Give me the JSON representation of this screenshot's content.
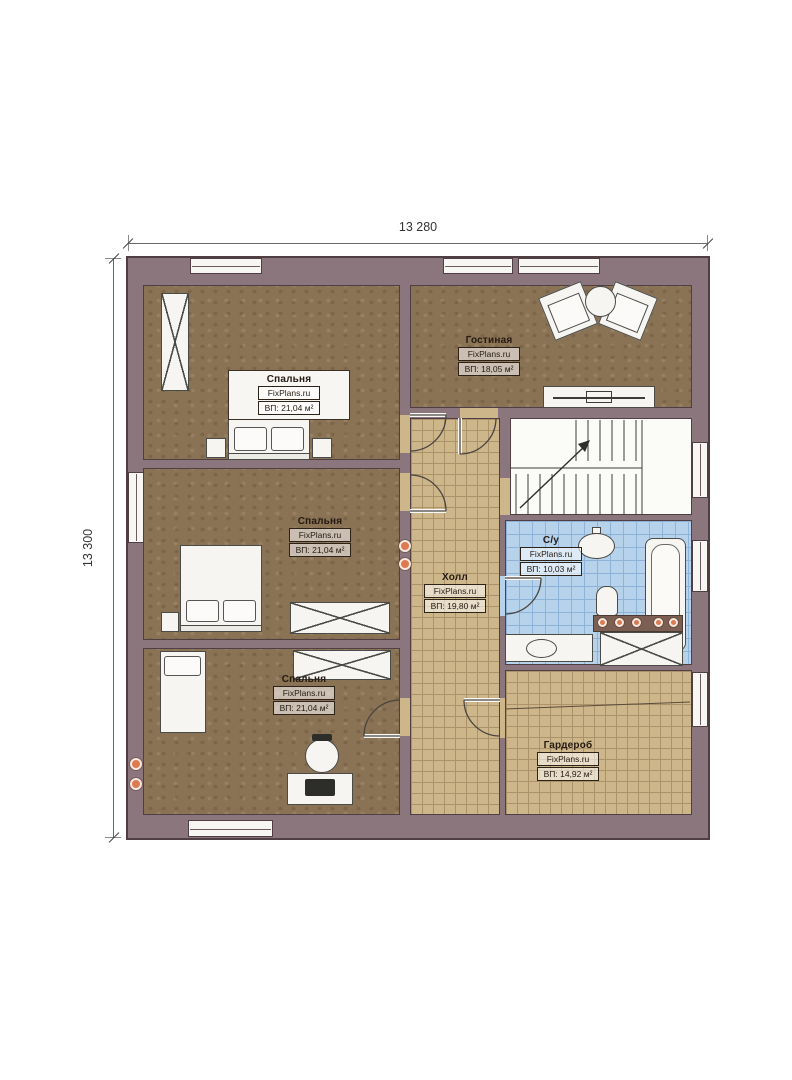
{
  "watermark": "FixPlans.ru",
  "dimensions": {
    "width_label": "13 280",
    "height_label": "13 300"
  },
  "rooms": [
    {
      "id": "bedroom-1",
      "name": "Спальня",
      "area": "ВП: 21,04 м²"
    },
    {
      "id": "bedroom-2",
      "name": "Спальня",
      "area": "ВП: 21,04 м²"
    },
    {
      "id": "bedroom-3",
      "name": "Спальня",
      "area": "ВП: 21,04 м²"
    },
    {
      "id": "living-room",
      "name": "Гостиная",
      "area": "ВП: 18,05 м²"
    },
    {
      "id": "hall",
      "name": "Холл",
      "area": "ВП: 19,80 м²"
    },
    {
      "id": "bathroom",
      "name": "С/у",
      "area": "ВП: 10,03 м²"
    },
    {
      "id": "wardrobe",
      "name": "Гардероб",
      "area": "ВП: 14,92 м²"
    }
  ],
  "colors": {
    "wall": "#8b767e",
    "wall_line": "#4f3f45",
    "bedroom_floor": "#8a7254",
    "tile_floor": "#cdb689",
    "tile_line": "#ab926a",
    "bath_floor": "#b7d3eb",
    "bath_line": "#8fb2d8",
    "furniture_fill": "#f6f5f2",
    "furniture_line": "#4a4a46",
    "accent_orange": "#dd7a50",
    "dim_line": "#3a3a3a"
  }
}
